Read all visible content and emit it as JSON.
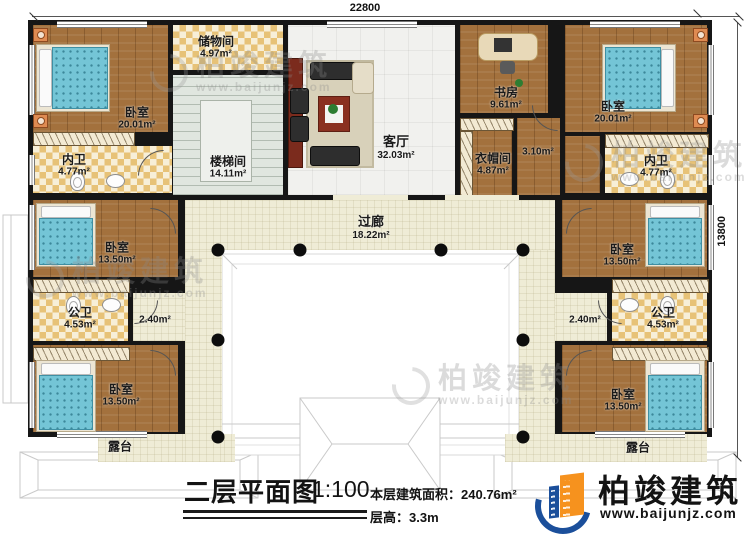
{
  "dimensions": {
    "top": "22800",
    "right": "13800"
  },
  "rooms": {
    "bedroom_tl": {
      "label": "卧室",
      "area": "20.01m²"
    },
    "storage": {
      "label": "储物间",
      "area": "4.97m²"
    },
    "stairwell": {
      "label": "楼梯间",
      "area": "14.11m²"
    },
    "living": {
      "label": "客厅",
      "area": "32.03m²"
    },
    "study": {
      "label": "书房",
      "area": "9.61m²"
    },
    "cloakroom": {
      "label": "衣帽间",
      "area": "4.87m²"
    },
    "hall_310": {
      "area": "3.10m²"
    },
    "bedroom_tr": {
      "label": "卧室",
      "area": "20.01m²"
    },
    "bath_inner_left": {
      "label": "内卫",
      "area": "4.77m²"
    },
    "bath_inner_right": {
      "label": "内卫",
      "area": "4.77m²"
    },
    "corridor": {
      "label": "过廊",
      "area": "18.22m²"
    },
    "bedroom_ml": {
      "label": "卧室",
      "area": "13.50m²"
    },
    "bedroom_mr": {
      "label": "卧室",
      "area": "13.50m²"
    },
    "bath_public_left": {
      "label": "公卫",
      "area": "4.53m²"
    },
    "bath_public_right": {
      "label": "公卫",
      "area": "4.53m²"
    },
    "hall_240_left": {
      "area": "2.40m²"
    },
    "hall_240_right": {
      "area": "2.40m²"
    },
    "bedroom_bl": {
      "label": "卧室",
      "area": "13.50m²"
    },
    "bedroom_br": {
      "label": "卧室",
      "area": "13.50m²"
    },
    "terrace_left": {
      "label": "露台"
    },
    "terrace_right": {
      "label": "露台"
    }
  },
  "title_block": {
    "title": "二层平面图",
    "scale": "1:100",
    "area_label": "本层建筑面积：",
    "area_value": "240.76m²",
    "height_label": "层高：",
    "height_value": "3.3m"
  },
  "logo": {
    "name": "柏竣建筑",
    "website": "www.baijunjz.com"
  },
  "watermark": {
    "name": "柏竣建筑",
    "website": "www.baijunjz.com"
  },
  "colors": {
    "wall": "#161616",
    "accent_blue": "#1b4f9b",
    "accent_orange": "#f6921e",
    "wood": "#a3713d",
    "tile_checker": "#e7c277",
    "corridor": "#efecd6"
  }
}
